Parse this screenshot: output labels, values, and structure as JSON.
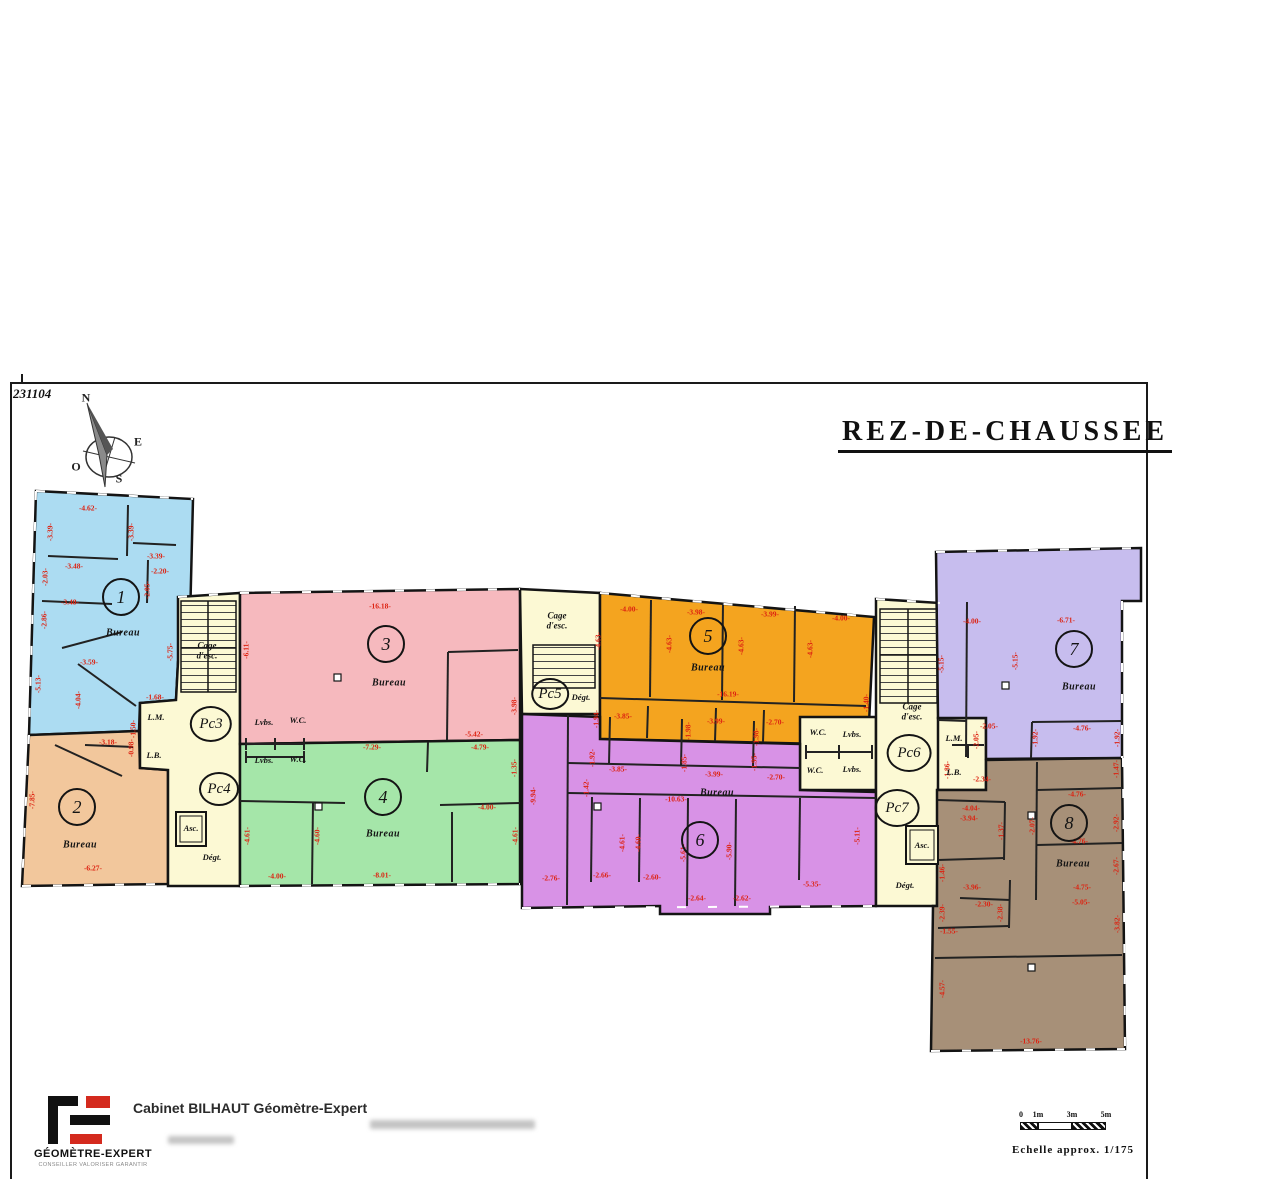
{
  "sheet": {
    "plan_number": "231104",
    "title": "REZ-DE-CHAUSSEE"
  },
  "compass": {
    "north": "N",
    "east": "E",
    "south": "S",
    "west": "O"
  },
  "colors": {
    "wall": "#141414",
    "measurement": "#dd2211",
    "corridor": "#fcf9d4",
    "zone1": "#acdcf2",
    "zone2": "#f2c79c",
    "zone3": "#f6b9be",
    "zone4": "#a5e6a9",
    "zone5": "#f4a41f",
    "zone6": "#d892e6",
    "zone7": "#c7bdee",
    "zone8": "#a79078"
  },
  "plan": {
    "zones": [
      {
        "number": "1",
        "room_label": "Bureau",
        "color": "#acdcf2",
        "circle": {
          "x": 121,
          "y": 597
        },
        "label_pos": {
          "x": 123,
          "y": 633
        }
      },
      {
        "number": "2",
        "room_label": "Bureau",
        "color": "#f2c79c",
        "circle": {
          "x": 77,
          "y": 807
        },
        "label_pos": {
          "x": 80,
          "y": 845
        }
      },
      {
        "number": "3",
        "room_label": "Bureau",
        "color": "#f6b9be",
        "circle": {
          "x": 386,
          "y": 644
        },
        "label_pos": {
          "x": 389,
          "y": 683
        }
      },
      {
        "number": "4",
        "room_label": "Bureau",
        "color": "#a5e6a9",
        "circle": {
          "x": 383,
          "y": 797
        },
        "label_pos": {
          "x": 383,
          "y": 834
        }
      },
      {
        "number": "5",
        "room_label": "Bureau",
        "color": "#f4a41f",
        "circle": {
          "x": 708,
          "y": 636
        },
        "label_pos": {
          "x": 708,
          "y": 668
        }
      },
      {
        "number": "6",
        "room_label": "Bureau",
        "color": "#d892e6",
        "circle": {
          "x": 700,
          "y": 840
        },
        "label_pos": {
          "x": 717,
          "y": 793
        }
      },
      {
        "number": "7",
        "room_label": "Bureau",
        "color": "#c7bdee",
        "circle": {
          "x": 1074,
          "y": 649
        },
        "label_pos": {
          "x": 1079,
          "y": 687
        }
      },
      {
        "number": "8",
        "room_label": "Bureau",
        "color": "#a79078",
        "circle": {
          "x": 1069,
          "y": 823
        },
        "label_pos": {
          "x": 1073,
          "y": 864
        }
      }
    ],
    "pc_circles": [
      {
        "t": "Pc3",
        "x": 211,
        "y": 724,
        "r": 16
      },
      {
        "t": "Pc4",
        "x": 219,
        "y": 789,
        "r": 15
      },
      {
        "t": "Pc5",
        "x": 550,
        "y": 694,
        "r": 14
      },
      {
        "t": "Pc6",
        "x": 909,
        "y": 753,
        "r": 17
      },
      {
        "t": "Pc7",
        "x": 897,
        "y": 808,
        "r": 17
      }
    ],
    "room_labels": [
      {
        "t": "Cage\nd'esc.",
        "x": 207,
        "y": 651,
        "cls": "cage"
      },
      {
        "t": "L.M.",
        "x": 156,
        "y": 718
      },
      {
        "t": "L.B.",
        "x": 154,
        "y": 756
      },
      {
        "t": "Lvbs.",
        "x": 264,
        "y": 723
      },
      {
        "t": "W.C.",
        "x": 298,
        "y": 721
      },
      {
        "t": "Lvbs.",
        "x": 264,
        "y": 761
      },
      {
        "t": "W.C.",
        "x": 298,
        "y": 760
      },
      {
        "t": "Asc.",
        "x": 191,
        "y": 829
      },
      {
        "t": "Dégt.",
        "x": 212,
        "y": 858
      },
      {
        "t": "Cage\nd'esc.",
        "x": 557,
        "y": 621,
        "cls": "cage"
      },
      {
        "t": "Dégt.",
        "x": 581,
        "y": 698
      },
      {
        "t": "W.C.",
        "x": 818,
        "y": 733
      },
      {
        "t": "Lvbs.",
        "x": 852,
        "y": 735
      },
      {
        "t": "W.C.",
        "x": 815,
        "y": 771
      },
      {
        "t": "Lvbs.",
        "x": 852,
        "y": 770
      },
      {
        "t": "Cage\nd'esc.",
        "x": 912,
        "y": 712,
        "cls": "cage"
      },
      {
        "t": "L.M.",
        "x": 954,
        "y": 739
      },
      {
        "t": "L.B.",
        "x": 954,
        "y": 773
      },
      {
        "t": "Asc.",
        "x": 922,
        "y": 846
      },
      {
        "t": "Dégt.",
        "x": 905,
        "y": 886
      }
    ],
    "measurements": [
      {
        "t": "-4.62-",
        "x": 88,
        "y": 508
      },
      {
        "t": "-3.39-",
        "x": 50,
        "y": 532,
        "v": 1
      },
      {
        "t": "-3.39-",
        "x": 131,
        "y": 532,
        "v": 1
      },
      {
        "t": "-3.39-",
        "x": 156,
        "y": 556
      },
      {
        "t": "-3.48-",
        "x": 74,
        "y": 566
      },
      {
        "t": "-2.20-",
        "x": 160,
        "y": 571
      },
      {
        "t": "-2.03-",
        "x": 45,
        "y": 577,
        "v": 1
      },
      {
        "t": "-2.05-",
        "x": 147,
        "y": 590,
        "v": 1
      },
      {
        "t": "-3.48-",
        "x": 70,
        "y": 602
      },
      {
        "t": "-2.86-",
        "x": 44,
        "y": 620,
        "v": 1
      },
      {
        "t": "-5.75-",
        "x": 170,
        "y": 652,
        "v": 1
      },
      {
        "t": "-3.59-",
        "x": 89,
        "y": 662
      },
      {
        "t": "-5.13-",
        "x": 38,
        "y": 684,
        "v": 1
      },
      {
        "t": "-4.04-",
        "x": 78,
        "y": 700,
        "v": 1
      },
      {
        "t": "-1.68-",
        "x": 155,
        "y": 697
      },
      {
        "t": "-3.18-",
        "x": 108,
        "y": 742
      },
      {
        "t": "-1.50-",
        "x": 133,
        "y": 729,
        "v": 1
      },
      {
        "t": "-0.98-",
        "x": 131,
        "y": 748,
        "v": 1
      },
      {
        "t": "-7.85-",
        "x": 32,
        "y": 800,
        "v": 1
      },
      {
        "t": "-6.27-",
        "x": 93,
        "y": 868
      },
      {
        "t": "-16.18-",
        "x": 380,
        "y": 606
      },
      {
        "t": "-6.11-",
        "x": 246,
        "y": 650,
        "v": 1
      },
      {
        "t": "-3.98-",
        "x": 514,
        "y": 706,
        "v": 1
      },
      {
        "t": "-5.42-",
        "x": 474,
        "y": 734
      },
      {
        "t": "-7.29-",
        "x": 372,
        "y": 747
      },
      {
        "t": "-4.79-",
        "x": 480,
        "y": 747
      },
      {
        "t": "-1.35-",
        "x": 514,
        "y": 768,
        "v": 1
      },
      {
        "t": "-4.00-",
        "x": 487,
        "y": 807
      },
      {
        "t": "-4.61-",
        "x": 247,
        "y": 836,
        "v": 1
      },
      {
        "t": "-4.60-",
        "x": 317,
        "y": 836,
        "v": 1
      },
      {
        "t": "-4.61-",
        "x": 515,
        "y": 836,
        "v": 1
      },
      {
        "t": "-4.00-",
        "x": 277,
        "y": 876
      },
      {
        "t": "-8.01-",
        "x": 382,
        "y": 875
      },
      {
        "t": "-4.00-",
        "x": 629,
        "y": 609
      },
      {
        "t": "-3.98-",
        "x": 696,
        "y": 612
      },
      {
        "t": "-3.99-",
        "x": 770,
        "y": 614
      },
      {
        "t": "-4.00-",
        "x": 841,
        "y": 618
      },
      {
        "t": "-4.63-",
        "x": 598,
        "y": 641,
        "v": 1
      },
      {
        "t": "-4.63-",
        "x": 669,
        "y": 644,
        "v": 1
      },
      {
        "t": "-4.63-",
        "x": 741,
        "y": 646,
        "v": 1
      },
      {
        "t": "-4.63-",
        "x": 810,
        "y": 649,
        "v": 1
      },
      {
        "t": "-16.19-",
        "x": 728,
        "y": 694
      },
      {
        "t": "-3.85-",
        "x": 623,
        "y": 716
      },
      {
        "t": "-3.99-",
        "x": 716,
        "y": 721
      },
      {
        "t": "-2.70-",
        "x": 775,
        "y": 722
      },
      {
        "t": "-1.94-",
        "x": 596,
        "y": 719,
        "v": 1
      },
      {
        "t": "-1.98-",
        "x": 688,
        "y": 731,
        "v": 1
      },
      {
        "t": "-1.98-",
        "x": 756,
        "y": 737,
        "v": 1
      },
      {
        "t": "-1.40-",
        "x": 866,
        "y": 703,
        "v": 1
      },
      {
        "t": "-3.85-",
        "x": 618,
        "y": 769
      },
      {
        "t": "-3.99-",
        "x": 714,
        "y": 774
      },
      {
        "t": "-2.70-",
        "x": 776,
        "y": 777
      },
      {
        "t": "-1.92-",
        "x": 592,
        "y": 758,
        "v": 1
      },
      {
        "t": "-1.85-",
        "x": 684,
        "y": 763,
        "v": 1
      },
      {
        "t": "-1.95-",
        "x": 754,
        "y": 762,
        "v": 1
      },
      {
        "t": "-1.42-",
        "x": 586,
        "y": 788,
        "v": 1
      },
      {
        "t": "-10.63-",
        "x": 676,
        "y": 799
      },
      {
        "t": "-9.94-",
        "x": 533,
        "y": 796,
        "v": 1
      },
      {
        "t": "-4.61-",
        "x": 622,
        "y": 843,
        "v": 1
      },
      {
        "t": "-4.60-",
        "x": 638,
        "y": 843,
        "v": 1
      },
      {
        "t": "-5.61-",
        "x": 683,
        "y": 853,
        "v": 1
      },
      {
        "t": "-5.90-",
        "x": 729,
        "y": 851,
        "v": 1
      },
      {
        "t": "-5.11-",
        "x": 857,
        "y": 836,
        "v": 1
      },
      {
        "t": "-2.76-",
        "x": 551,
        "y": 878
      },
      {
        "t": "-2.66-",
        "x": 602,
        "y": 875
      },
      {
        "t": "-2.60-",
        "x": 652,
        "y": 877
      },
      {
        "t": "-2.64-",
        "x": 697,
        "y": 898
      },
      {
        "t": "-2.62-",
        "x": 742,
        "y": 898
      },
      {
        "t": "-5.35-",
        "x": 812,
        "y": 884
      },
      {
        "t": "-4.00-",
        "x": 972,
        "y": 621
      },
      {
        "t": "-6.71-",
        "x": 1066,
        "y": 620
      },
      {
        "t": "-5.15-",
        "x": 941,
        "y": 664,
        "v": 1
      },
      {
        "t": "-5.15-",
        "x": 1015,
        "y": 661,
        "v": 1
      },
      {
        "t": "-2.05-",
        "x": 989,
        "y": 726
      },
      {
        "t": "-4.76-",
        "x": 1082,
        "y": 728
      },
      {
        "t": "-2.05-",
        "x": 976,
        "y": 740,
        "v": 1
      },
      {
        "t": "-1.92-",
        "x": 1035,
        "y": 738,
        "v": 1
      },
      {
        "t": "-1.92-",
        "x": 1117,
        "y": 738,
        "v": 1
      },
      {
        "t": "-2.34-",
        "x": 982,
        "y": 779
      },
      {
        "t": "-1.86-",
        "x": 947,
        "y": 770,
        "v": 1
      },
      {
        "t": "-4.76-",
        "x": 1077,
        "y": 794
      },
      {
        "t": "-1.47-",
        "x": 1116,
        "y": 769,
        "v": 1
      },
      {
        "t": "-4.04-",
        "x": 971,
        "y": 808
      },
      {
        "t": "-3.94-",
        "x": 969,
        "y": 818
      },
      {
        "t": "-2.92-",
        "x": 1116,
        "y": 823,
        "v": 1
      },
      {
        "t": "-1.37-",
        "x": 1001,
        "y": 831,
        "v": 1
      },
      {
        "t": "-2.07-",
        "x": 1032,
        "y": 826,
        "v": 1
      },
      {
        "t": "-4.76-",
        "x": 1079,
        "y": 841
      },
      {
        "t": "-2.67-",
        "x": 1116,
        "y": 866,
        "v": 1
      },
      {
        "t": "-3.96-",
        "x": 972,
        "y": 887
      },
      {
        "t": "-4.75-",
        "x": 1082,
        "y": 887
      },
      {
        "t": "-1.46-",
        "x": 942,
        "y": 873,
        "v": 1
      },
      {
        "t": "-2.30-",
        "x": 984,
        "y": 904
      },
      {
        "t": "-2.39-",
        "x": 942,
        "y": 913,
        "v": 1
      },
      {
        "t": "-2.38-",
        "x": 1000,
        "y": 913,
        "v": 1
      },
      {
        "t": "-1.55-",
        "x": 949,
        "y": 931
      },
      {
        "t": "-5.05-",
        "x": 1081,
        "y": 902
      },
      {
        "t": "-3.82-",
        "x": 1117,
        "y": 924,
        "v": 1
      },
      {
        "t": "-4.57-",
        "x": 942,
        "y": 989,
        "v": 1
      },
      {
        "t": "-13.76-",
        "x": 1031,
        "y": 1041
      }
    ]
  },
  "footer": {
    "logo_title": "GÉOMÈTRE-EXPERT",
    "logo_tagline": "CONSEILLER VALORISER GARANTIR",
    "cabinet_name": "Cabinet BILHAUT Géomètre-Expert"
  },
  "scale_bar": {
    "ticks": [
      "0",
      "1m",
      "3m",
      "5m"
    ],
    "caption": "Echelle approx. 1/175"
  }
}
